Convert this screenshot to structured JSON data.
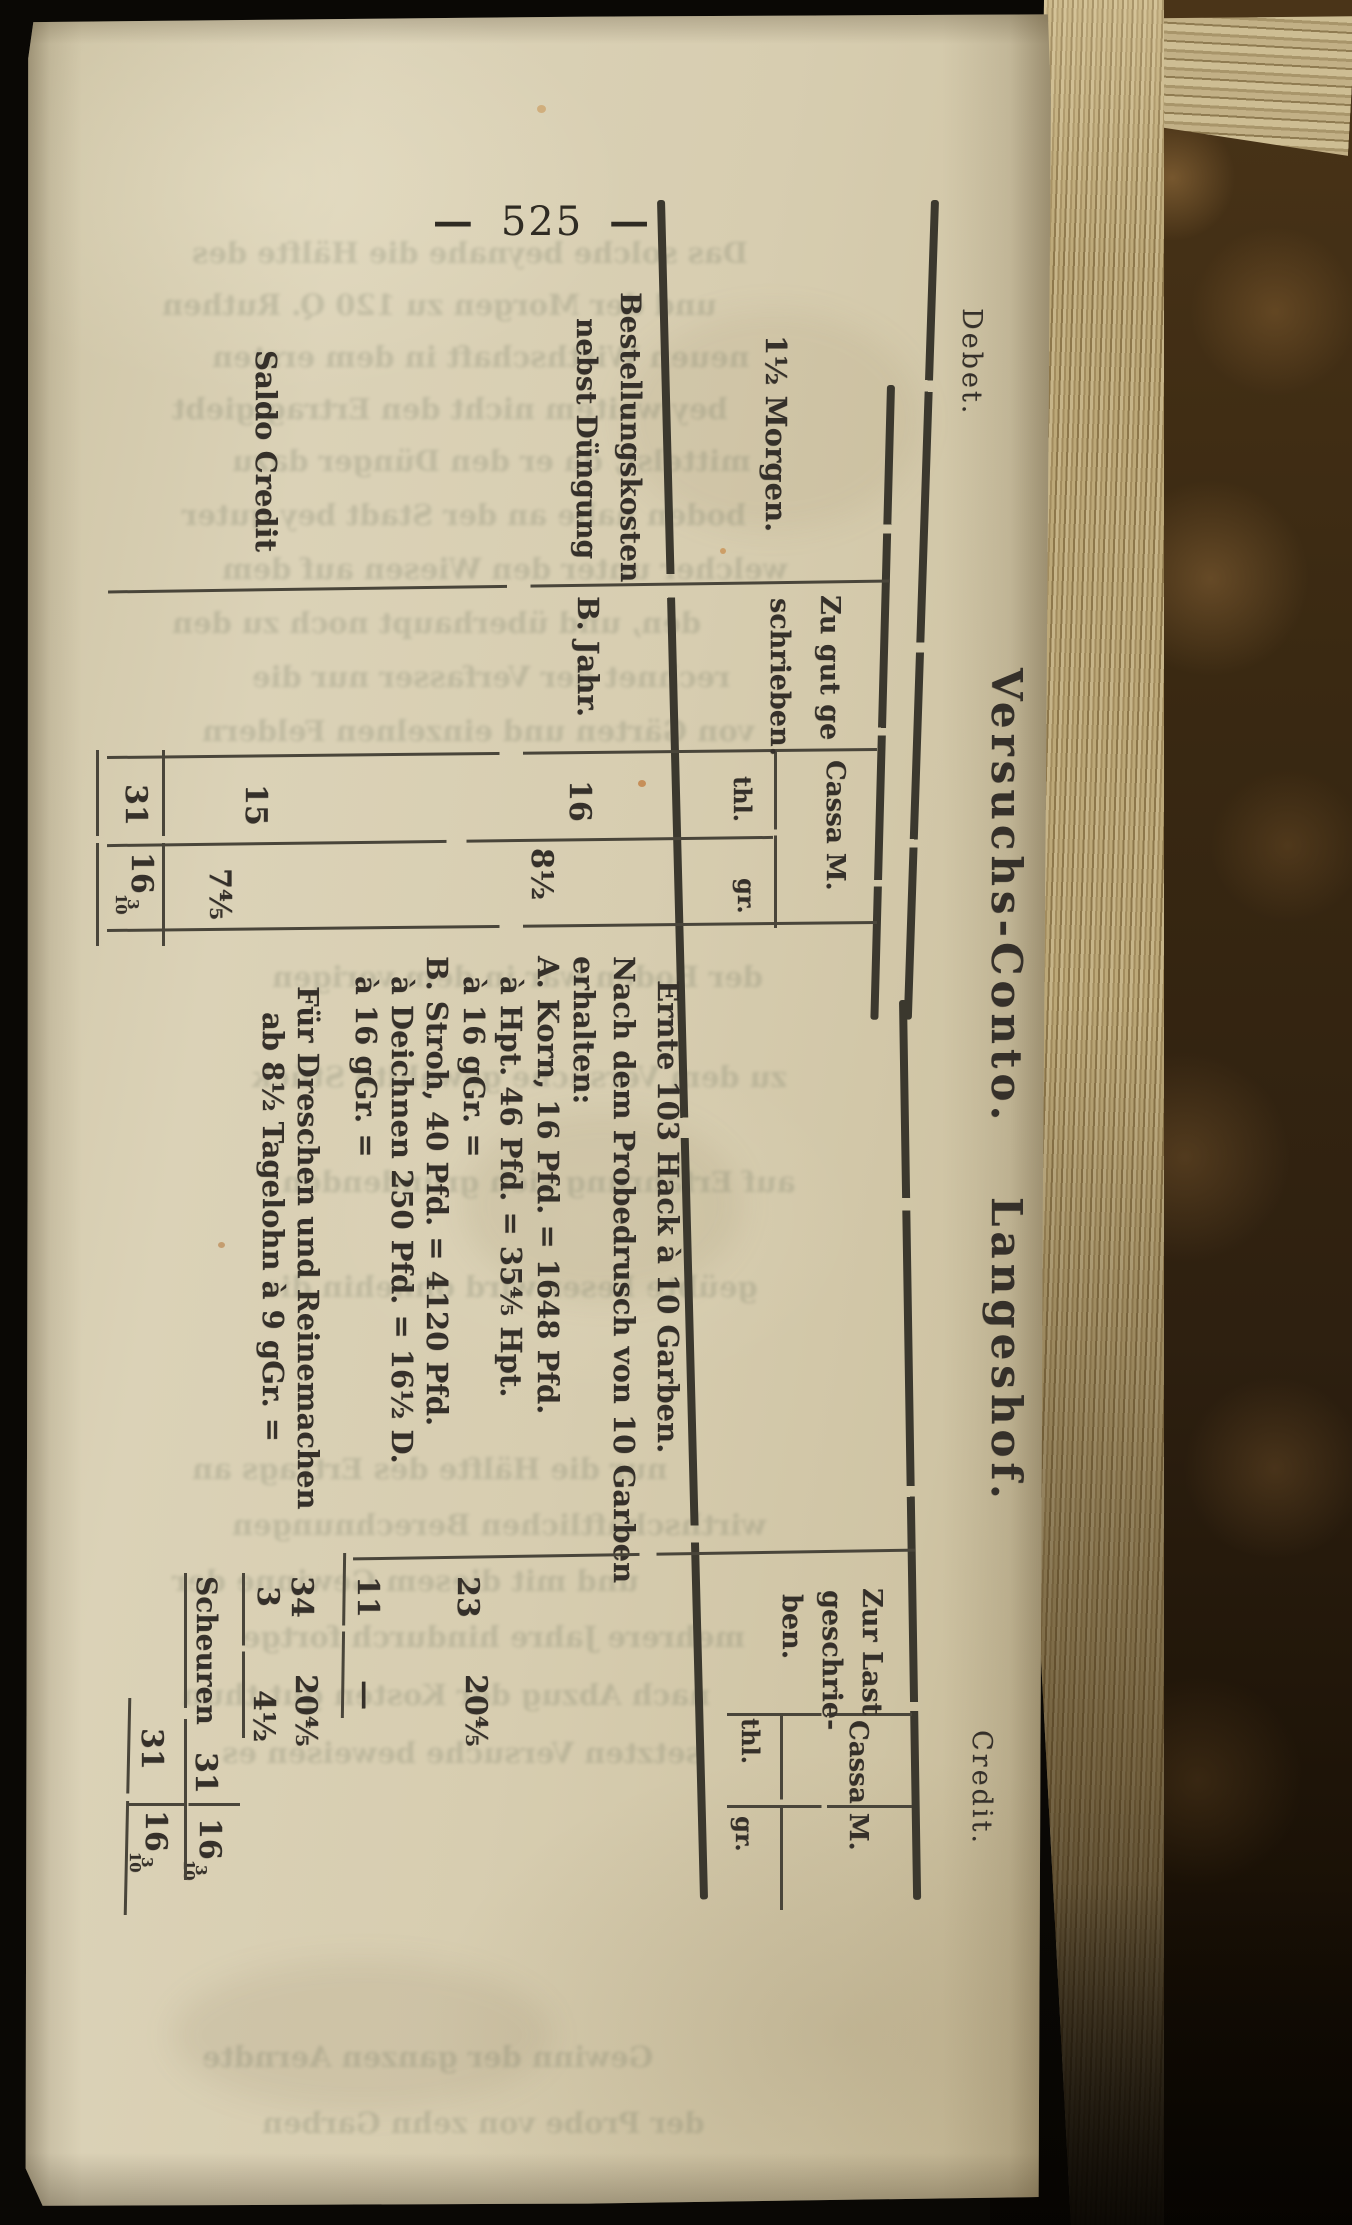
{
  "page": {
    "number": "525",
    "dash": "—"
  },
  "ledger": {
    "title": "Versuchs-Conto. Langeshof.",
    "debet_label": "Debet.",
    "credit_label": "Credit.",
    "debet": {
      "morgen_label": "1½ Morgen.",
      "credited_header_lines": [
        "Zu gut ge",
        "schrieben."
      ],
      "cassa": "Cassa M.",
      "thl": "thl.",
      "gr": "gr.",
      "rows": [
        {
          "label1": "Bestellungskosten",
          "label2": "nebst Düngung",
          "note": "B. Jahr.",
          "thl": "16",
          "gr": "8½"
        },
        {
          "label1": "Saldo Credit",
          "label2": "",
          "note": "",
          "thl": "15",
          "gr": "7⅘"
        }
      ],
      "total": {
        "thl": "31",
        "gr_int": "16",
        "gr_num": "3",
        "gr_den": "10"
      }
    },
    "description": {
      "lines": [
        "Ernte 103 Hack à 10 Garben.",
        "Nach dem Probedrusch von 10 Garben",
        "erhalten:",
        "A. Korn, 16 Pfd. = 1648 Pfd.",
        "à Hpt. 46 Pfd. = 35⅘ Hpt.",
        "à 16 gGr. =",
        "B. Stroh, 40 Pfd. = 4120 Pfd.",
        "à Deichnen 250 Pfd. = 16½ D.",
        "à 16 gGr. ="
      ],
      "deduction_lines": [
        "Für Dreschen und Reinemachen",
        "ab 8½ Tagelohn à 9 gGr. ="
      ]
    },
    "credit": {
      "charged_header_lines": [
        "Zur Last",
        "geschrie-",
        "ben."
      ],
      "cassa": "Cassa M.",
      "thl": "thl.",
      "gr": "gr.",
      "entries": [
        {
          "thl": "23",
          "gr": "20⅘"
        },
        {
          "thl": "11",
          "gr": "—"
        }
      ],
      "subtotal": {
        "thl": "34",
        "gr": "20⅘"
      },
      "deduction": {
        "thl": "3",
        "gr": "4½"
      },
      "note": "Scheuren",
      "result": {
        "thl": "31",
        "gr_int": "16",
        "gr_num": "3",
        "gr_den": "10"
      },
      "total": {
        "thl": "31",
        "gr_int": "16",
        "gr_num": "3",
        "gr_den": "10"
      }
    }
  },
  "ghost": [
    "Das solche beynahe die Hälfte des",
    "und der Morgen zu 120 Q. Ruthen",
    "neuen Wirthschaft in dem ersten",
    "bey weitem nicht den Ertrag giebt",
    "mittelst, da er den Dünger dazu",
    "boden nahe an der Stadt bey guter",
    "welcher unter den Wiesen auf dem",
    "den, und überhaupt noch zu den",
    "rechnet der Verfasser nur die",
    "von Gärten und einzelnen Feldern",
    "der Boden war in dem vorigen",
    "zu dem Versuche gewählte Stück",
    "auf Erfahrung sich gründenden",
    "geübte Leser wird ohnehin die",
    "nur die Hälfte des Ertrags an",
    "wirthschaftlichen Berechnungen",
    "und mit diesem Gewinne der",
    "mehrere Jahre hindurch fortge",
    "nach Abzug der Kosten gut thun",
    "setzten Versuche beweisen es",
    "Gewinn der ganzen Aerndte",
    "der Probe von zehn Garben"
  ]
}
